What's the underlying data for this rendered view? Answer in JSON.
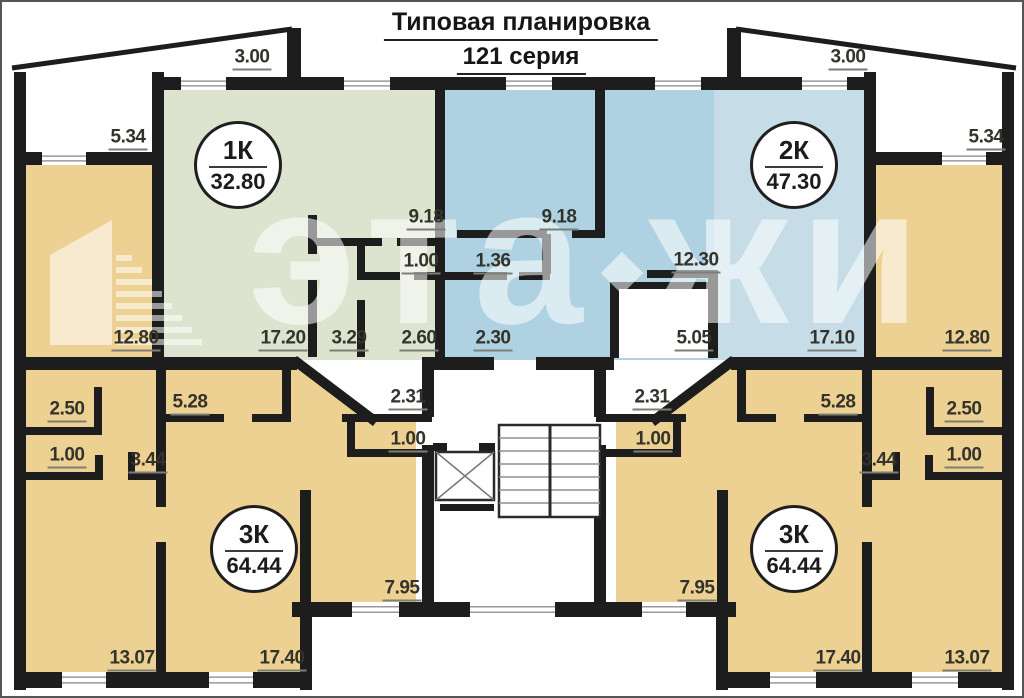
{
  "title": {
    "line1": "Типовая планировка",
    "line2": "121 серия"
  },
  "watermark": {
    "part1": "эта",
    "part2": "жи"
  },
  "apartments": [
    {
      "type": "1К",
      "area": "32.80",
      "x": 236,
      "y": 163
    },
    {
      "type": "2К",
      "area": "47.30",
      "x": 792,
      "y": 163
    },
    {
      "type": "3К",
      "area": "64.44",
      "x": 252,
      "y": 547
    },
    {
      "type": "3К",
      "area": "64.44",
      "x": 792,
      "y": 547
    }
  ],
  "dimensions": [
    {
      "value": "3.00",
      "x": 250,
      "y": 57
    },
    {
      "value": "3.00",
      "x": 846,
      "y": 57
    },
    {
      "value": "5.34",
      "x": 126,
      "y": 137
    },
    {
      "value": "5.34",
      "x": 984,
      "y": 137
    },
    {
      "value": "9.18",
      "x": 424,
      "y": 217
    },
    {
      "value": "9.18",
      "x": 557,
      "y": 217
    },
    {
      "value": "1.00",
      "x": 419,
      "y": 261
    },
    {
      "value": "1.36",
      "x": 491,
      "y": 261
    },
    {
      "value": "12.30",
      "x": 694,
      "y": 260
    },
    {
      "value": "12.80",
      "x": 134,
      "y": 338
    },
    {
      "value": "17.20",
      "x": 281,
      "y": 338
    },
    {
      "value": "3.29",
      "x": 347,
      "y": 338
    },
    {
      "value": "2.60",
      "x": 417,
      "y": 338
    },
    {
      "value": "2.30",
      "x": 491,
      "y": 338
    },
    {
      "value": "5.05",
      "x": 692,
      "y": 338
    },
    {
      "value": "17.10",
      "x": 830,
      "y": 338
    },
    {
      "value": "12.80",
      "x": 965,
      "y": 338
    },
    {
      "value": "2.50",
      "x": 65,
      "y": 409
    },
    {
      "value": "5.28",
      "x": 188,
      "y": 402
    },
    {
      "value": "2.31",
      "x": 406,
      "y": 397
    },
    {
      "value": "2.31",
      "x": 650,
      "y": 397
    },
    {
      "value": "5.28",
      "x": 836,
      "y": 402
    },
    {
      "value": "2.50",
      "x": 962,
      "y": 409
    },
    {
      "value": "1.00",
      "x": 65,
      "y": 455
    },
    {
      "value": "3.44",
      "x": 146,
      "y": 460
    },
    {
      "value": "1.00",
      "x": 406,
      "y": 439
    },
    {
      "value": "1.00",
      "x": 651,
      "y": 439
    },
    {
      "value": "3.44",
      "x": 877,
      "y": 460
    },
    {
      "value": "1.00",
      "x": 962,
      "y": 455
    },
    {
      "value": "7.95",
      "x": 400,
      "y": 588
    },
    {
      "value": "7.95",
      "x": 695,
      "y": 588
    },
    {
      "value": "13.07",
      "x": 130,
      "y": 658
    },
    {
      "value": "17.40",
      "x": 280,
      "y": 658
    },
    {
      "value": "17.40",
      "x": 836,
      "y": 658
    },
    {
      "value": "13.07",
      "x": 965,
      "y": 658
    }
  ],
  "colors": {
    "wall": "#1d1d1d",
    "room_tan": "#edd192",
    "room_green": "#dce4cf",
    "room_blue": "#aed2e1",
    "room_blue_light": "#c6dde8",
    "label_text": "#33332c",
    "label_underline": "#7e7e76"
  }
}
